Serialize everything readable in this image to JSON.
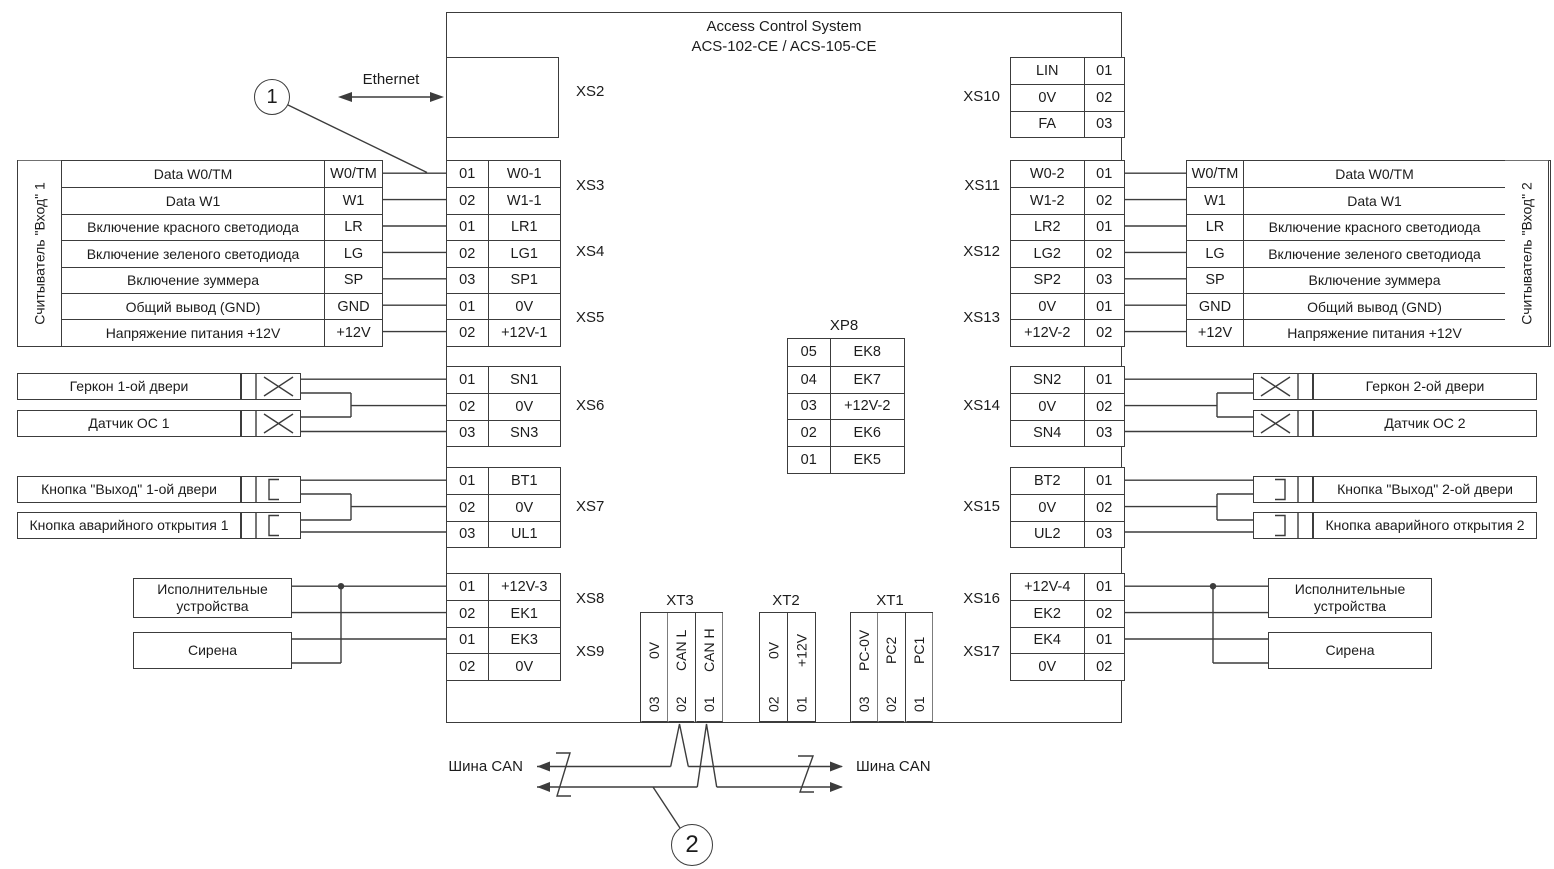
{
  "title": {
    "line1": "Access Control System",
    "line2": "ACS-102-CE / ACS-105-CE"
  },
  "ethernet_label": "Ethernet",
  "xs2_label": "XS2",
  "callout_1": "1",
  "callout_2": "2",
  "can_bus_left": "Шина CAN",
  "can_bus_right": "Шина CAN",
  "reader1": {
    "side_label": "Считыватель \"Вход\" 1",
    "rows": [
      {
        "desc": "Data W0/TM",
        "sig": "W0/TM"
      },
      {
        "desc": "Data W1",
        "sig": "W1"
      },
      {
        "desc": "Включение красного светодиода",
        "sig": "LR"
      },
      {
        "desc": "Включение зеленого светодиода",
        "sig": "LG"
      },
      {
        "desc": "Включение зуммера",
        "sig": "SP"
      },
      {
        "desc": "Общий вывод (GND)",
        "sig": "GND"
      },
      {
        "desc": "Напряжение питания +12V",
        "sig": "+12V"
      }
    ]
  },
  "reader2": {
    "side_label": "Считыватель \"Вход\" 2",
    "rows": [
      {
        "desc": "Data W0/TM",
        "sig": "W0/TM"
      },
      {
        "desc": "Data W1",
        "sig": "W1"
      },
      {
        "desc": "Включение красного светодиода",
        "sig": "LR"
      },
      {
        "desc": "Включение зеленого светодиода",
        "sig": "LG"
      },
      {
        "desc": "Включение зуммера",
        "sig": "SP"
      },
      {
        "desc": "Общий вывод (GND)",
        "sig": "GND"
      },
      {
        "desc": "Напряжение питания +12V",
        "sig": "+12V"
      }
    ]
  },
  "left_connectors": [
    {
      "name": "XS3",
      "rows": [
        {
          "pin": "01",
          "sig": "W0-1"
        },
        {
          "pin": "02",
          "sig": "W1-1"
        }
      ]
    },
    {
      "name": "XS4",
      "rows": [
        {
          "pin": "01",
          "sig": "LR1"
        },
        {
          "pin": "02",
          "sig": "LG1"
        },
        {
          "pin": "03",
          "sig": "SP1"
        }
      ]
    },
    {
      "name": "XS5",
      "rows": [
        {
          "pin": "01",
          "sig": "0V"
        },
        {
          "pin": "02",
          "sig": "+12V-1"
        }
      ]
    },
    {
      "name": "XS6",
      "rows": [
        {
          "pin": "01",
          "sig": "SN1"
        },
        {
          "pin": "02",
          "sig": "0V"
        },
        {
          "pin": "03",
          "sig": "SN3"
        }
      ]
    },
    {
      "name": "XS7",
      "rows": [
        {
          "pin": "01",
          "sig": "BT1"
        },
        {
          "pin": "02",
          "sig": "0V"
        },
        {
          "pin": "03",
          "sig": "UL1"
        }
      ]
    },
    {
      "name": "XS8",
      "rows": [
        {
          "pin": "01",
          "sig": "+12V-3"
        },
        {
          "pin": "02",
          "sig": "EK1"
        }
      ]
    },
    {
      "name": "XS9",
      "rows": [
        {
          "pin": "01",
          "sig": "EK3"
        },
        {
          "pin": "02",
          "sig": "0V"
        }
      ]
    }
  ],
  "right_connectors": [
    {
      "name": "XS10",
      "rows": [
        {
          "sig": "LIN",
          "pin": "01"
        },
        {
          "sig": "0V",
          "pin": "02"
        },
        {
          "sig": "FA",
          "pin": "03"
        }
      ]
    },
    {
      "name": "XS11",
      "rows": [
        {
          "sig": "W0-2",
          "pin": "01"
        },
        {
          "sig": "W1-2",
          "pin": "02"
        }
      ]
    },
    {
      "name": "XS12",
      "rows": [
        {
          "sig": "LR2",
          "pin": "01"
        },
        {
          "sig": "LG2",
          "pin": "02"
        },
        {
          "sig": "SP2",
          "pin": "03"
        }
      ]
    },
    {
      "name": "XS13",
      "rows": [
        {
          "sig": "0V",
          "pin": "01"
        },
        {
          "sig": "+12V-2",
          "pin": "02"
        }
      ]
    },
    {
      "name": "XS14",
      "rows": [
        {
          "sig": "SN2",
          "pin": "01"
        },
        {
          "sig": "0V",
          "pin": "02"
        },
        {
          "sig": "SN4",
          "pin": "03"
        }
      ]
    },
    {
      "name": "XS15",
      "rows": [
        {
          "sig": "BT2",
          "pin": "01"
        },
        {
          "sig": "0V",
          "pin": "02"
        },
        {
          "sig": "UL2",
          "pin": "03"
        }
      ]
    },
    {
      "name": "XS16",
      "rows": [
        {
          "sig": "+12V-4",
          "pin": "01"
        },
        {
          "sig": "EK2",
          "pin": "02"
        }
      ]
    },
    {
      "name": "XS17",
      "rows": [
        {
          "sig": "EK4",
          "pin": "01"
        },
        {
          "sig": "0V",
          "pin": "02"
        }
      ]
    }
  ],
  "xp8": {
    "name": "XP8",
    "rows": [
      {
        "pin": "05",
        "sig": "EK8"
      },
      {
        "pin": "04",
        "sig": "EK7"
      },
      {
        "pin": "03",
        "sig": "+12V-2"
      },
      {
        "pin": "02",
        "sig": "EK6"
      },
      {
        "pin": "01",
        "sig": "EK5"
      }
    ]
  },
  "xt": [
    {
      "name": "XT3",
      "cols": [
        {
          "sig": "0V",
          "pin": "03"
        },
        {
          "sig": "CAN L",
          "pin": "02"
        },
        {
          "sig": "CAN H",
          "pin": "01"
        }
      ]
    },
    {
      "name": "XT2",
      "cols": [
        {
          "sig": "0V",
          "pin": "02"
        },
        {
          "sig": "+12V",
          "pin": "01"
        }
      ]
    },
    {
      "name": "XT1",
      "cols": [
        {
          "sig": "PC-0V",
          "pin": "03"
        },
        {
          "sig": "PC2",
          "pin": "02"
        },
        {
          "sig": "PC1",
          "pin": "01"
        }
      ]
    }
  ],
  "devices_left": {
    "gerkon": "Геркон 1-ой двери",
    "datchik": "Датчик ОС 1",
    "exit_btn": "Кнопка \"Выход\" 1-ой двери",
    "emergency_btn": "Кнопка аварийного открытия 1",
    "actuators": "Исполнительные устройства",
    "siren": "Сирена"
  },
  "devices_right": {
    "gerkon": "Геркон 2-ой двери",
    "datchik": "Датчик ОС 2",
    "exit_btn": "Кнопка \"Выход\" 2-ой двери",
    "emergency_btn": "Кнопка аварийного открытия 2",
    "actuators": "Исполнительные устройства",
    "siren": "Сирена"
  }
}
